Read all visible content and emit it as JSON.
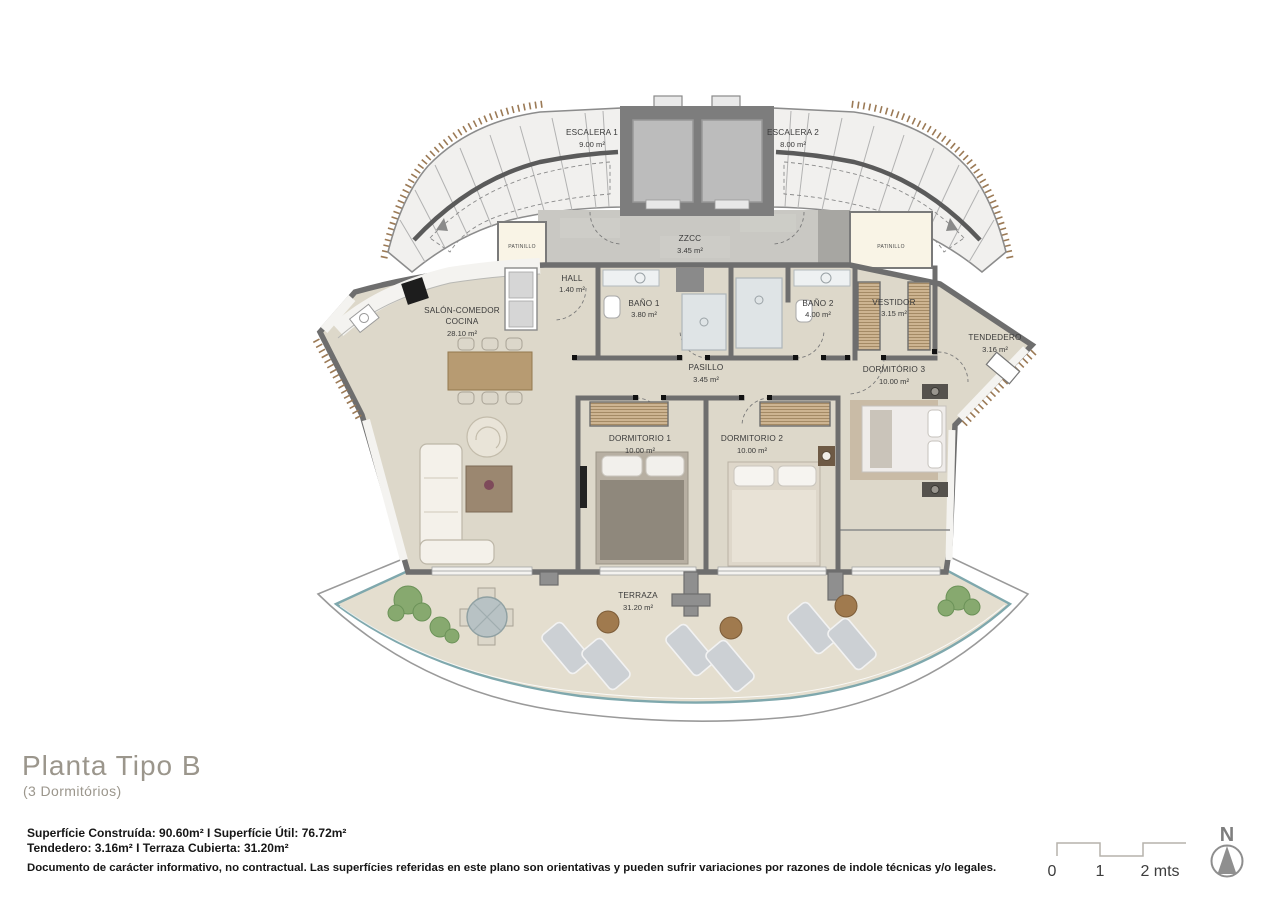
{
  "plan_title": {
    "main": "Planta Tipo B",
    "subtitle": "(3 Dormitórios)"
  },
  "rooms": {
    "escalera1": {
      "name": "ESCALERA 1",
      "area": "9.00 m²"
    },
    "escalera2": {
      "name": "ESCALERA 2",
      "area": "8.00 m²"
    },
    "zzcc": {
      "name": "ZZCC",
      "area": "3.45 m²"
    },
    "patinillo_left": {
      "name": "PATINILLO"
    },
    "patinillo_right": {
      "name": "PATINILLO"
    },
    "hall": {
      "name": "HALL",
      "area": "1.40 m²"
    },
    "salon": {
      "name1": "SALÓN-COMEDOR",
      "name2": "COCINA",
      "area": "28.10 m²"
    },
    "bano1": {
      "name": "BAÑO 1",
      "area": "3.80 m²"
    },
    "bano2": {
      "name": "BAÑO 2",
      "area": "4.00 m²"
    },
    "vestidor": {
      "name": "VESTIDOR",
      "area": "3.15 m²"
    },
    "tendedero": {
      "name": "TENDEDERO",
      "area": "3.16 m²"
    },
    "pasillo": {
      "name": "PASILLO",
      "area": "3.45 m²"
    },
    "dormitorio1": {
      "name": "DORMITORIO 1",
      "area": "10.00 m²"
    },
    "dormitorio2": {
      "name": "DORMITORIO 2",
      "area": "10.00 m²"
    },
    "dormitorio3": {
      "name": "DORMITÓRIO 3",
      "area": "10.00 m²"
    },
    "terraza": {
      "name": "TERRAZA",
      "area": "31.20 m²"
    }
  },
  "details": {
    "line1": "Superfície Construída: 90.60m² I Superfície Útil: 76.72m²",
    "line2": "Tendedero: 3.16m² I Terraza Cubierta: 31.20m²",
    "disclaimer": "Documento de carácter informativo, no contractual. Las superfícies referidas en este plano son orientativas y pueden sufrir variaciones por razones de indole técnicas y/o legales."
  },
  "scale_bar": {
    "tick0": "0",
    "tick1": "1",
    "tick2": "2 mts"
  },
  "compass": {
    "label": "N"
  },
  "colors": {
    "floor": "#ddd8ca",
    "terrace_floor": "#e4decf",
    "wall": "#6e6e6e",
    "stairs": "#f1f0ee",
    "lobby": "#c9c8c3",
    "patinillo": "#f9f4e6",
    "railing": "#7fa8ad",
    "wood": "#b79b72",
    "hatch_ticks": "#9b7a56",
    "plant": "#7da465",
    "text": "#3a3a3a"
  }
}
